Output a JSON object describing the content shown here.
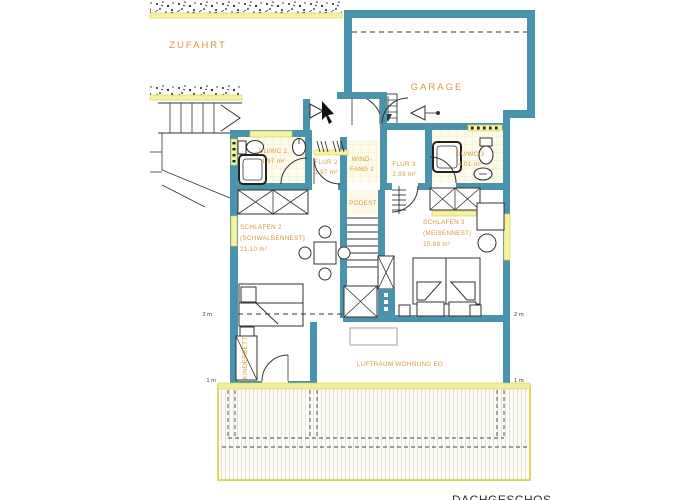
{
  "plan": {
    "site": {
      "zufahrt_label": "ZUFAHRT",
      "garage_label": "GARAGE"
    },
    "rooms": {
      "bath2": {
        "name": "DU/WC 2",
        "area": "4.97 m²"
      },
      "flur2": {
        "name": "FLUR 2",
        "area": "1.97 m²"
      },
      "windfang": {
        "name_line1": "WIND-",
        "name_line2": "FANG 2"
      },
      "flur3": {
        "name": "FLUR 3",
        "area": "2.93 m²"
      },
      "bath3": {
        "name": "DU/WC 3",
        "area": "4.01 m²"
      },
      "podest": {
        "name": "PODEST"
      },
      "schlafen2": {
        "name": "SCHLAFEN 2",
        "nickname": "(SCHWALBENNEST)",
        "area": "21.10 m²"
      },
      "schlafen3": {
        "name": "SCHLAFEN 3",
        "nickname": "(MEISENNEST)",
        "area": "15.89 m²"
      },
      "luftraum": {
        "name": "LUFTRAUM WOHNUNG EG"
      },
      "kinderbett": {
        "name": "KINDERBETT"
      }
    },
    "dimension_marks": {
      "left_2m": "2 m",
      "right_2m": "2 m",
      "left_1m": "1 m",
      "right_1m": "1 m"
    },
    "caption_partial": "DACHGESCHOS",
    "colors": {
      "wall": "#4a93ac",
      "label_text": "#d9983b",
      "window_fill": "#f5f1a8",
      "window_border": "#d8d345",
      "terrace_border": "#ddd75f",
      "line": "#333333"
    }
  }
}
